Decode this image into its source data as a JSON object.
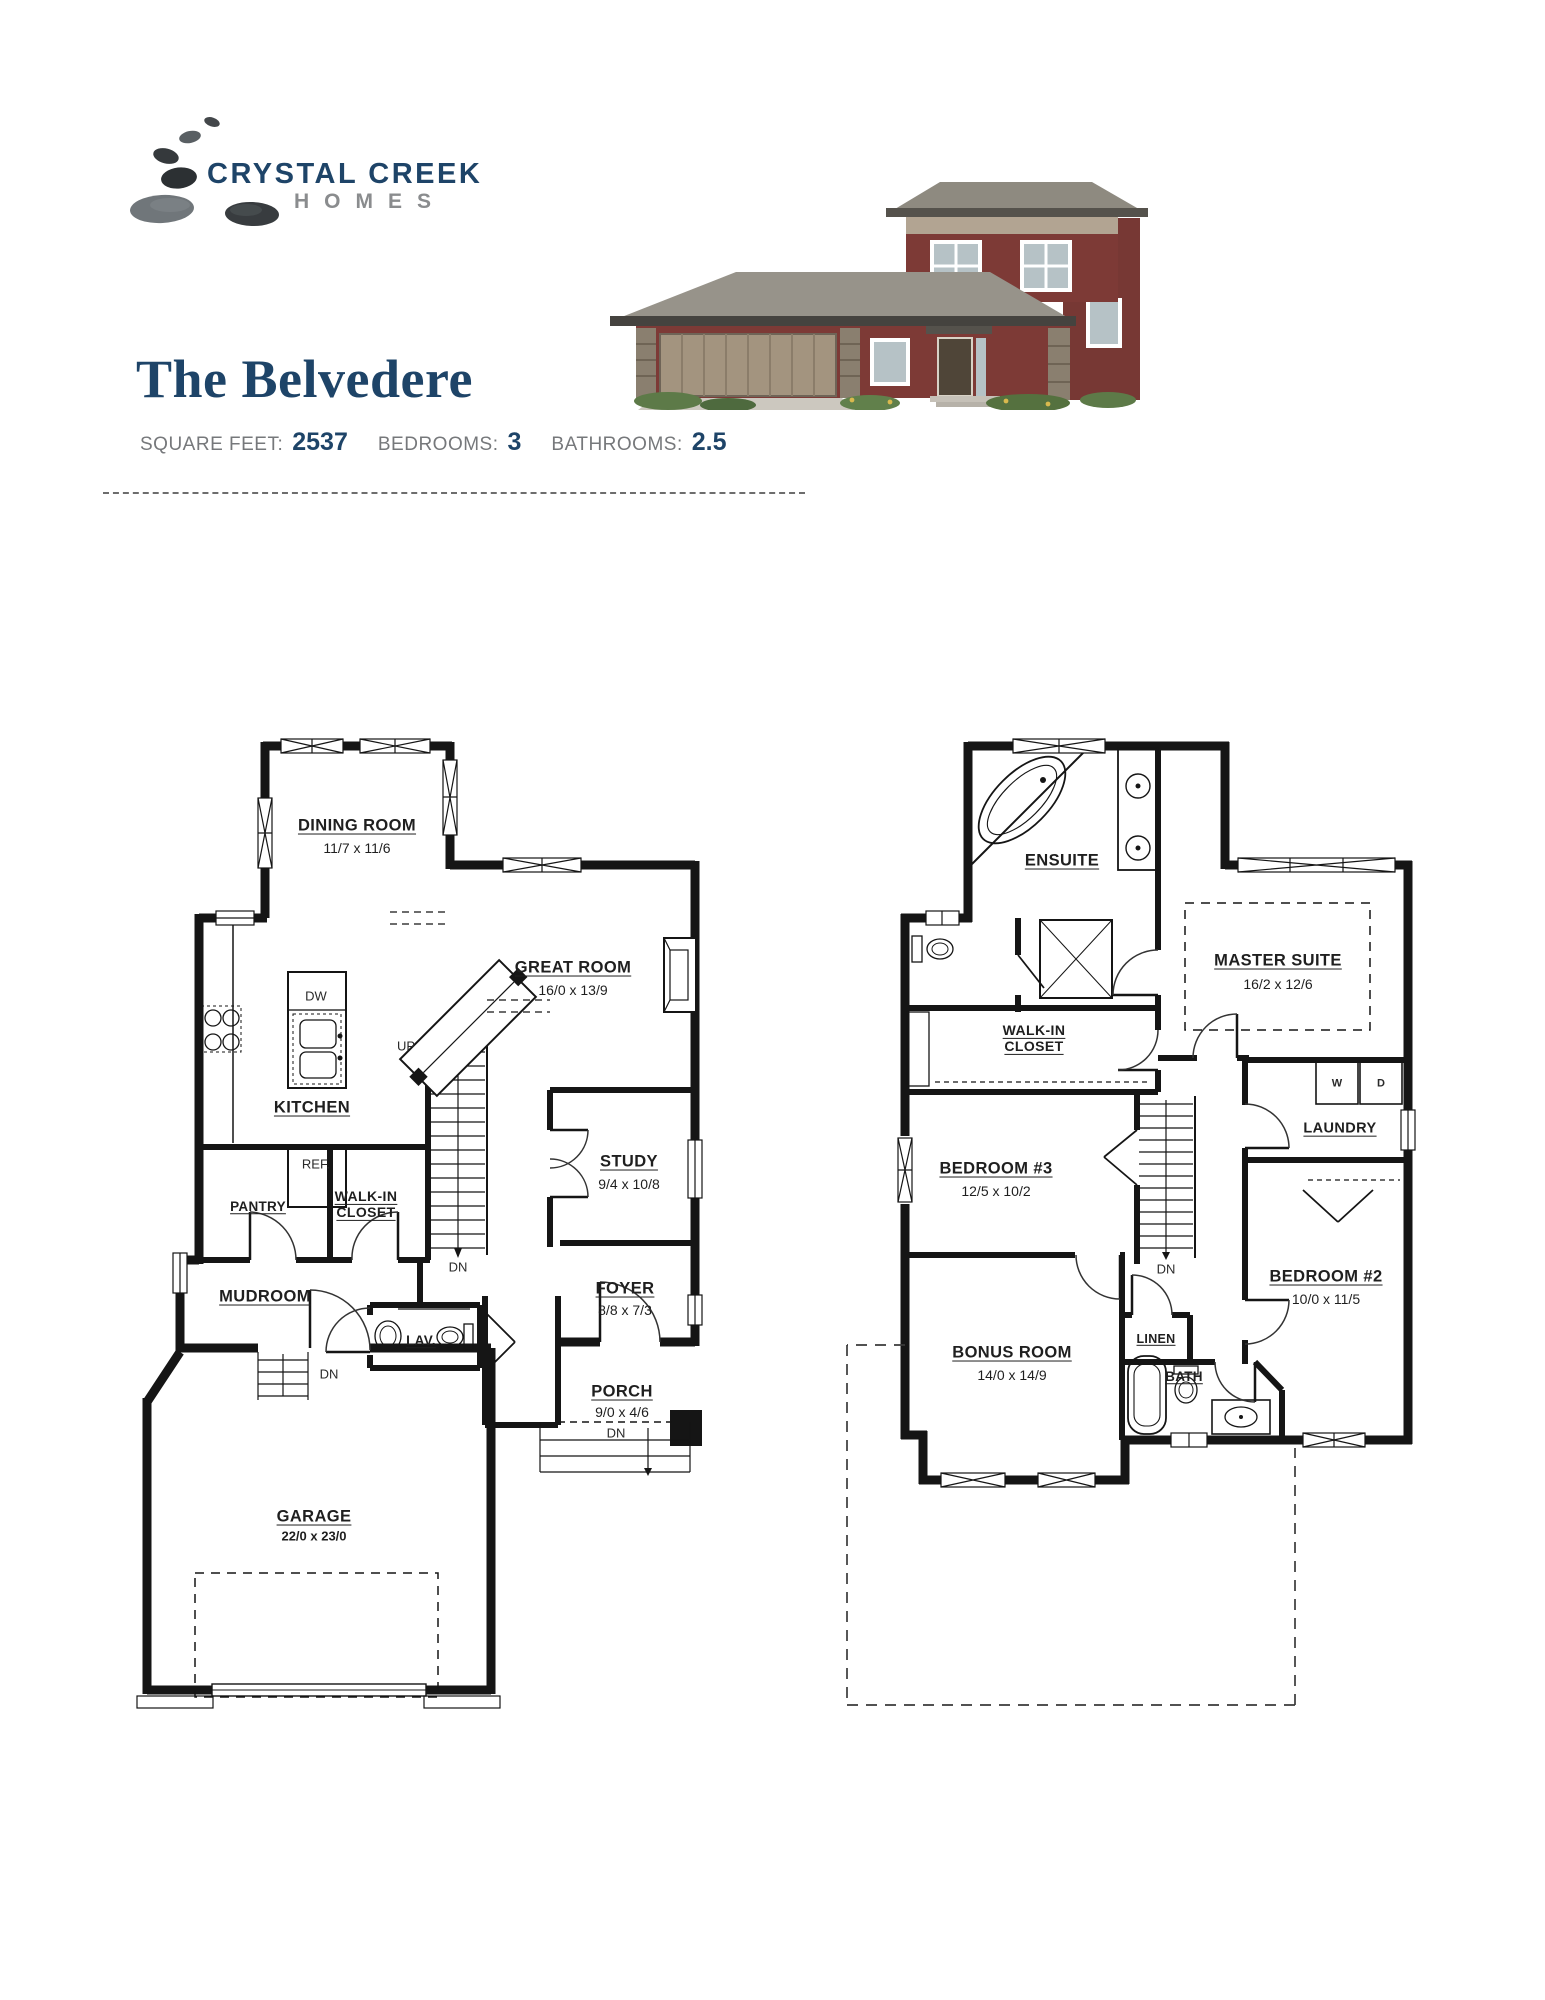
{
  "logo": {
    "line1": "CRYSTAL CREEK",
    "line2": "HOMES",
    "color_primary": "#1e4468",
    "color_secondary": "#8a8c8e"
  },
  "header": {
    "title": "The Belvedere",
    "title_color": "#1e4468",
    "specs": [
      {
        "label": "SQUARE FEET:",
        "value": "2537"
      },
      {
        "label": "BEDROOMS:",
        "value": "3"
      },
      {
        "label": "BATHROOMS:",
        "value": "2.5"
      }
    ]
  },
  "plans": {
    "main": {
      "rooms": [
        {
          "name": "DINING ROOM",
          "dims": "11/7 x 11/6"
        },
        {
          "name": "GREAT ROOM",
          "dims": "16/0 x 13/9"
        },
        {
          "name": "KITCHEN",
          "dims": ""
        },
        {
          "name": "STUDY",
          "dims": "9/4 x 10/8"
        },
        {
          "name": "PANTRY",
          "dims": ""
        },
        {
          "name": "WALK-IN CLOSET",
          "dims": ""
        },
        {
          "name": "MUDROOM",
          "dims": ""
        },
        {
          "name": "LAV.",
          "dims": ""
        },
        {
          "name": "FOYER",
          "dims": "8/8 x 7/3"
        },
        {
          "name": "PORCH",
          "dims": "9/0 x 4/6"
        },
        {
          "name": "GARAGE",
          "dims": "22/0 x 23/0"
        }
      ],
      "marks": {
        "up": "UP",
        "dn": "DN",
        "dw": "DW",
        "ref": "REF."
      }
    },
    "upper": {
      "rooms": [
        {
          "name": "ENSUITE",
          "dims": ""
        },
        {
          "name": "MASTER SUITE",
          "dims": "16/2 x 12/6"
        },
        {
          "name": "WALK-IN CLOSET",
          "dims": ""
        },
        {
          "name": "LAUNDRY",
          "dims": ""
        },
        {
          "name": "BEDROOM #3",
          "dims": "12/5 x 10/2"
        },
        {
          "name": "BEDROOM #2",
          "dims": "10/0 x 11/5"
        },
        {
          "name": "BONUS ROOM",
          "dims": "14/0 x 14/9"
        },
        {
          "name": "LINEN",
          "dims": ""
        },
        {
          "name": "BATH",
          "dims": ""
        }
      ],
      "marks": {
        "dn": "DN",
        "w": "W",
        "d": "D"
      }
    }
  }
}
